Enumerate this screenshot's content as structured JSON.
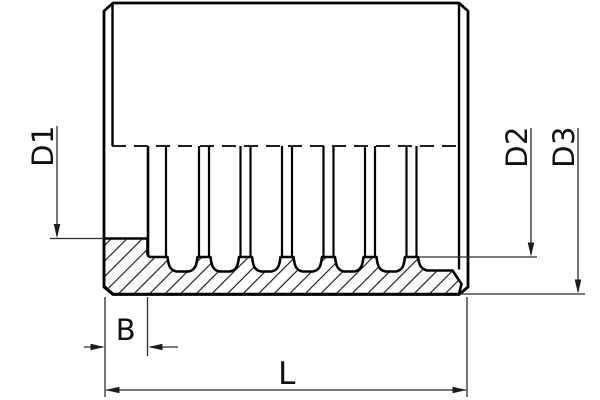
{
  "drawing": {
    "dimensions": {
      "d1": {
        "label": "D1"
      },
      "d2": {
        "label": "D2"
      },
      "d3": {
        "label": "D3"
      },
      "b": {
        "label": "B"
      },
      "l": {
        "label": "L"
      }
    },
    "colors": {
      "outline": "#000000",
      "dimension_lines": "#2b2b2b",
      "background": "#ffffff"
    }
  }
}
